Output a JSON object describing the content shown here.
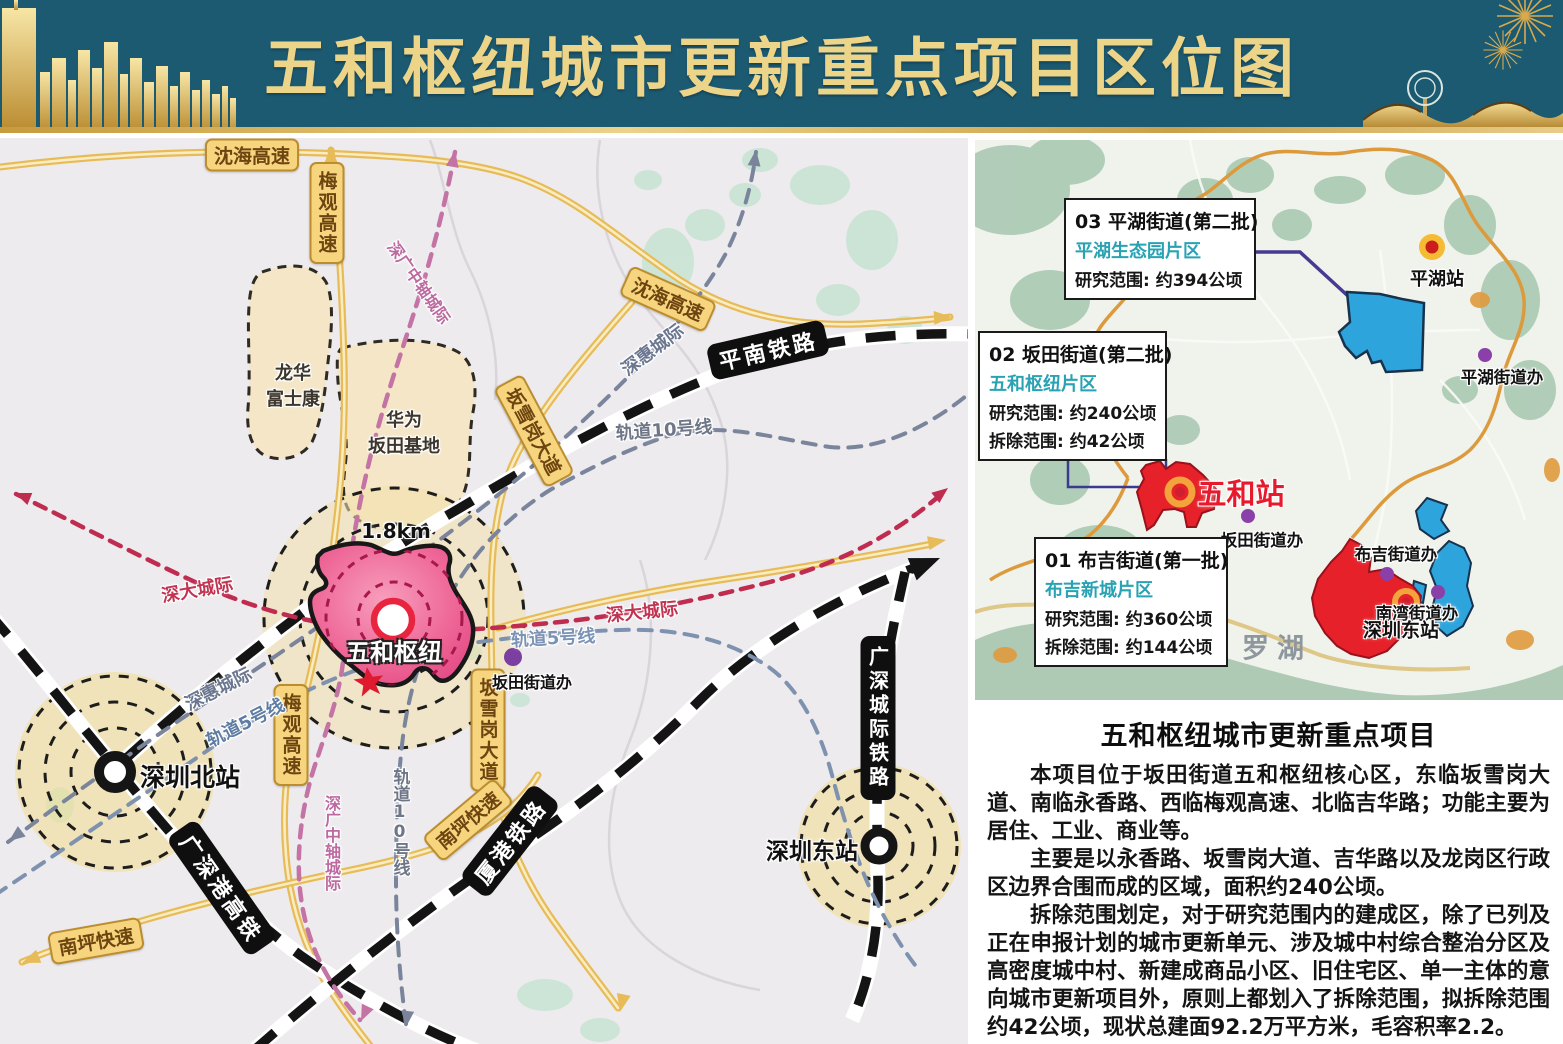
{
  "banner": {
    "title": "五和枢纽城市更新重点项目区位图"
  },
  "colors": {
    "banner_bg": "#1c5a72",
    "banner_gold": "#e9d083",
    "callout_teal": "#29a3b4",
    "wuhe_red": "#e8192d"
  },
  "map": {
    "scale_label": "1.8km",
    "roads": {
      "shenhai": "沈海高速",
      "meiguan": "梅观高速",
      "banxuegang": "坂雪岗大道",
      "nanping": "南坪快速"
    },
    "railways": {
      "pingnan": "平南铁路",
      "guangshengang_hsr": "广深港高铁",
      "xiagang": "厦港铁路",
      "guangshen_intercity": "广深城际铁路"
    },
    "transit": {
      "shenhui": "深惠城际",
      "metro10": "轨道10号线",
      "metro5": "轨道5号线",
      "shenda": "深大城际",
      "central_axis": "深广中轴城际"
    },
    "areas": {
      "longhua_line1": "龙华",
      "longhua_line2": "富士康",
      "huawei_line1": "华为",
      "huawei_line2": "坂田基地"
    },
    "stations": {
      "shenzhen_north": "深圳北站",
      "shenzhen_east": "深圳东站",
      "wuhe_hub": "五和枢纽",
      "bantian_office": "坂田街道办"
    }
  },
  "inset": {
    "callouts": [
      {
        "id": "03",
        "title": "03 平湖街道(第二批)",
        "subtitle": "平湖生态园片区",
        "lines": [
          "研究范围: 约394公顷"
        ]
      },
      {
        "id": "02",
        "title": "02 坂田街道(第二批)",
        "subtitle": "五和枢纽片区",
        "lines": [
          "研究范围: 约240公顷",
          "拆除范围: 约42公顷"
        ]
      },
      {
        "id": "01",
        "title": "01 布吉街道(第一批)",
        "subtitle": "布吉新城片区",
        "lines": [
          "研究范围: 约360公顷",
          "拆除范围: 约144公顷"
        ]
      }
    ],
    "labels": {
      "pinghu_station": "平湖站",
      "pinghu_office": "平湖街道办",
      "wuhe_station": "五和站",
      "bantian_office": "坂田街道办",
      "buji_office": "布吉街道办",
      "nanwan_office": "南湾街道办",
      "shenzhen_east": "深圳东站",
      "luohu": "罗湖"
    }
  },
  "info": {
    "title": "五和枢纽城市更新重点项目",
    "paragraphs": [
      "本项目位于坂田街道五和枢纽核心区，东临坂雪岗大道、南临永香路、西临梅观高速、北临吉华路；功能主要为居住、工业、商业等。",
      "主要是以永香路、坂雪岗大道、吉华路以及龙岗区行政区边界合围而成的区域，面积约240公顷。",
      "拆除范围划定，对于研究范围内的建成区，除了已列及正在申报计划的城市更新单元、涉及城中村综合整治分区及高密度城中村、新建成商品小区、旧住宅区、单一主体的意向城市更新项目外，原则上都划入了拆除范围，拟拆除范围约42公顷，现状总建面92.2万平方米，毛容积率2.2。"
    ]
  }
}
